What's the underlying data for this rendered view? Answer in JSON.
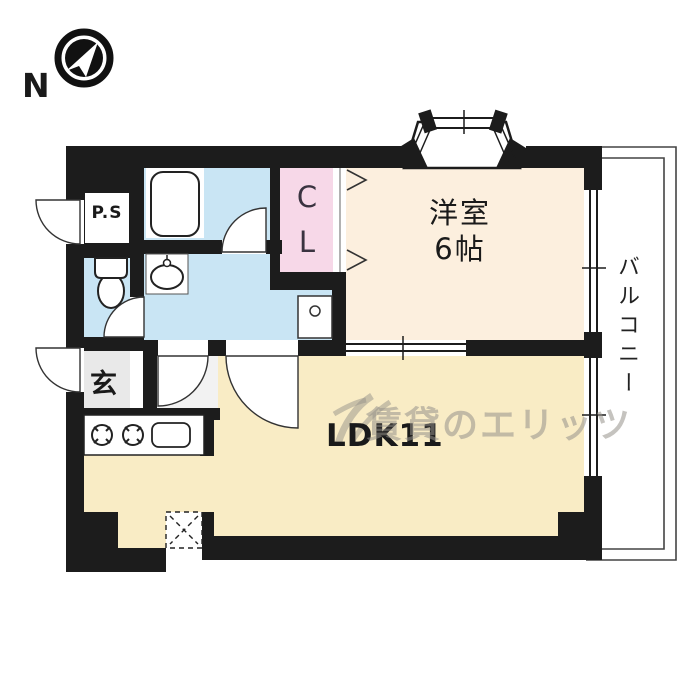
{
  "compass": {
    "label": "N"
  },
  "rooms": {
    "ps": {
      "label": "P.S"
    },
    "closet": {
      "label": "C\nL"
    },
    "western_room": {
      "label": "洋室\n6帖"
    },
    "balcony": {
      "label": "バルコニー"
    },
    "entrance": {
      "label": "玄"
    },
    "ldk": {
      "label": "LDK11"
    }
  },
  "watermark": {
    "text": "賃貸のエリッツ"
  },
  "colors": {
    "wall": "#1c1c1c",
    "wet_blue": "#c9e5f4",
    "closet_pink": "#f7d8e8",
    "western_cream": "#fcefde",
    "ldk_cream": "#f9ecc5",
    "entrance_gray": "#e9e9e9",
    "hall_gray": "#f2f2f2",
    "fixture_white": "#ffffff",
    "line_gray": "#444444"
  }
}
